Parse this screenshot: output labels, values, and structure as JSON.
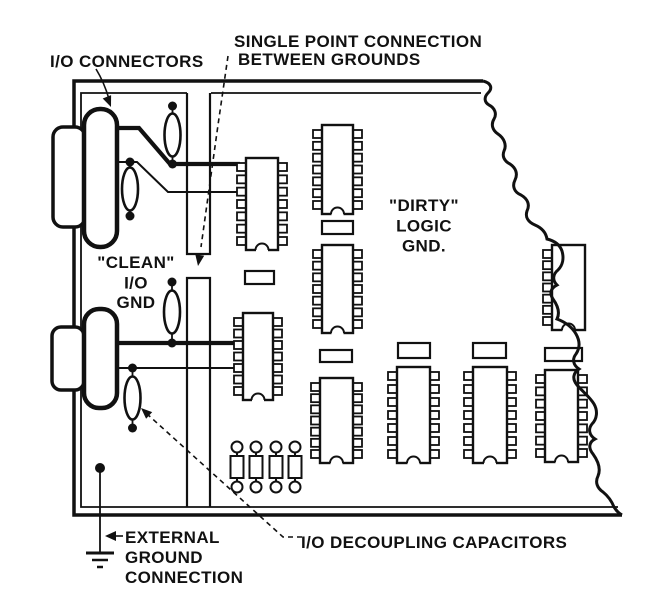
{
  "title": "Single point connection between clean I/O ground and dirty logic ground on a circuit board",
  "colors": {
    "ink": "#111111",
    "paper": "#ffffff"
  },
  "labels": {
    "io_connectors": "I/O CONNECTORS",
    "single_point_line1": "SINGLE POINT CONNECTION",
    "single_point_line2": "BETWEEN GROUNDS",
    "clean_gnd_line1": "\"CLEAN\"",
    "clean_gnd_line2": "I/O",
    "clean_gnd_line3": "GND",
    "dirty_gnd_line1": "\"DIRTY\"",
    "dirty_gnd_line2": "LOGIC",
    "dirty_gnd_line3": "GND.",
    "external_ground_line1": "EXTERNAL",
    "external_ground_line2": "GROUND",
    "external_ground_line3": "CONNECTION",
    "decoupling_caps": "I/O DECOUPLING CAPACITORS"
  },
  "components": {
    "dip_ics": [
      {
        "x": 246,
        "y": 158,
        "w": 32,
        "h": 92,
        "pins": "both"
      },
      {
        "x": 322,
        "y": 125,
        "w": 31,
        "h": 89,
        "pins": "both"
      },
      {
        "x": 322,
        "y": 245,
        "w": 31,
        "h": 88,
        "pins": "both"
      },
      {
        "x": 243,
        "y": 313,
        "w": 30,
        "h": 87,
        "pins": "both"
      },
      {
        "x": 320,
        "y": 378,
        "w": 33,
        "h": 85,
        "pins": "both"
      },
      {
        "x": 397,
        "y": 367,
        "w": 33,
        "h": 96,
        "pins": "both"
      },
      {
        "x": 473,
        "y": 367,
        "w": 34,
        "h": 96,
        "pins": "both"
      },
      {
        "x": 545,
        "y": 370,
        "w": 33,
        "h": 92,
        "pins": "both"
      },
      {
        "x": 552,
        "y": 245,
        "w": 33,
        "h": 85,
        "pins": "left"
      }
    ],
    "passive_rects": [
      {
        "x": 322,
        "y": 221,
        "w": 31,
        "h": 13
      },
      {
        "x": 245,
        "y": 271,
        "w": 29,
        "h": 13
      },
      {
        "x": 320,
        "y": 350,
        "w": 32,
        "h": 12
      },
      {
        "x": 398,
        "y": 343,
        "w": 32,
        "h": 15
      },
      {
        "x": 473,
        "y": 343,
        "w": 33,
        "h": 15
      },
      {
        "x": 545,
        "y": 348,
        "w": 37,
        "h": 13
      }
    ],
    "axial_capacitors": [
      {
        "cx": 237
      },
      {
        "cx": 256
      },
      {
        "cx": 276
      },
      {
        "cx": 295
      }
    ],
    "lens_capacitors": [
      {
        "cx": 172.5,
        "cy": 135,
        "dots": [
          [
            172.5,
            106
          ],
          [
            172.5,
            164
          ]
        ]
      },
      {
        "cx": 130,
        "cy": 189,
        "dots": [
          [
            130,
            162
          ],
          [
            130,
            216
          ]
        ]
      },
      {
        "cx": 172,
        "cy": 312,
        "dots": [
          [
            172,
            282
          ],
          [
            172,
            343
          ]
        ]
      },
      {
        "cx": 132.5,
        "cy": 398,
        "dots": [
          [
            132.5,
            368
          ],
          [
            132.5,
            428
          ]
        ]
      }
    ]
  }
}
